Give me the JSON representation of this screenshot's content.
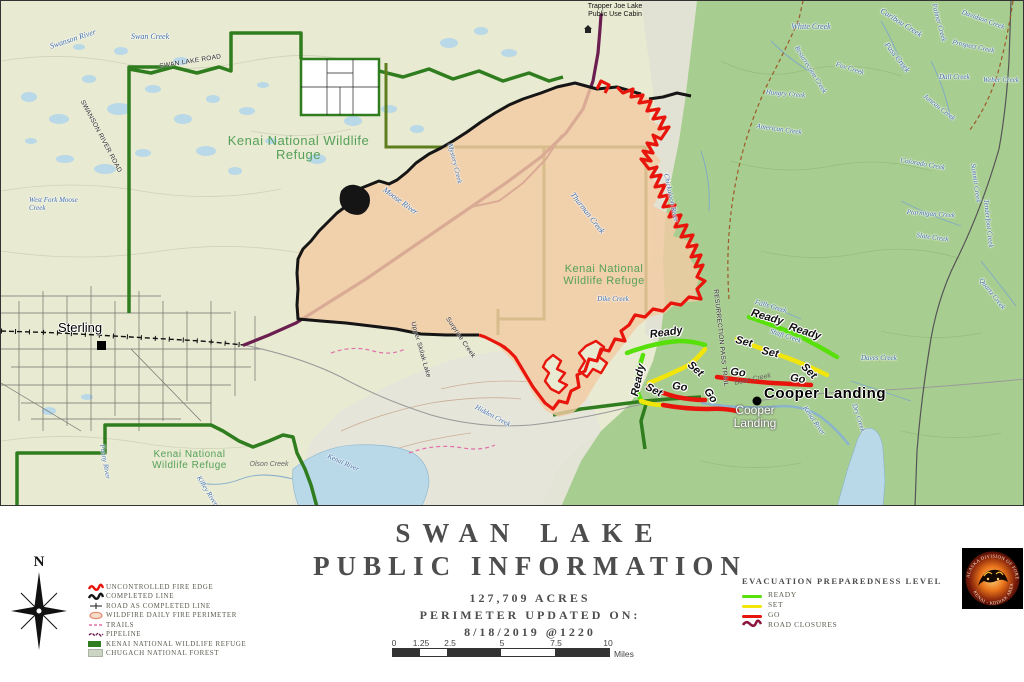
{
  "map": {
    "labels": {
      "swanson_river": "Swanson River",
      "swan_creek": "Swan Creek",
      "swan_lake_road": "SWAN LAKE ROAD",
      "swanson_river_road": "SWANSON RIVER ROAD",
      "refuge": "Kenai National Wildlife Refuge",
      "sterling": "Sterling",
      "trapper_joe": "Trapper Joe Lake Public Use Cabin",
      "moose_river": "Moose River",
      "mystery_creek": "Mystery Creek",
      "thurman_creek": "Thurman Creek",
      "dike_creek": "Dike Creek",
      "falls_creek": "Falls Creek",
      "shaft_creek": "Shaft Creek",
      "white_creek": "White Creek",
      "caribou_creek": "Caribou Creek",
      "pass_creek": "Pass Creek",
      "resurrection_creek": "Resurrection Creek",
      "fox_creek": "Fox Creek",
      "hungry_creek": "Hungry Creek",
      "dall_creek": "Dall Creek",
      "weber_creek": "Weber Creek",
      "american_creek": "American Creek",
      "colorado_creek": "Colorado Creek",
      "ptarmigan_creek": "Ptarmigan Creek",
      "slate_creek": "Slate Creek",
      "summit_creek": "Summit Creek",
      "tenderfoot_creek": "Tenderfoot Creek",
      "quartz_creek": "Quartz Creek",
      "juneau_creek": "Juneau Creek",
      "palmer_creek": "Palmer Creek",
      "prospect_creek": "Prospect Creek",
      "davidson_creek": "Davidson Creek",
      "olson_creek": "Olson Creek",
      "funny_river": "Funny River",
      "killey_river": "Killey River",
      "kenai_river": "Kenai River",
      "hidden_creek": "Hidden Creek",
      "upper_skilak": "Upper Skilak Lake",
      "surprise_creek": "Surprise Creek",
      "res_pass_trail": "RESURRECTION PASS TRAIL",
      "bean_creek": "Bean Creek",
      "daves_creek": "Daves Creek",
      "dry_creek": "Dry Creek",
      "chickaloon_river": "Chickaloon River",
      "west_fork": "West Fork Moose Creek",
      "cooper_landing": "Cooper Landing"
    },
    "evac": {
      "ready": "Ready",
      "set": "Set",
      "go": "Go"
    }
  },
  "footer": {
    "north": "N",
    "title_line1": "SWAN LAKE",
    "title_line2": "PUBLIC INFORMATION",
    "acres": "127,709 ACRES",
    "updated_label": "PERIMETER UPDATED ON:",
    "updated_value": "8/18/2019 @1220",
    "scale": {
      "ticks": [
        "0",
        "1.25",
        "2.5",
        "5",
        "7.5",
        "10"
      ],
      "unit": "Miles"
    },
    "legend": {
      "items": [
        "UNCONTROLLED FIRE EDGE",
        "COMPLETED LINE",
        "ROAD AS COMPLETED LINE",
        "WILDFIRE DAILY FIRE PERIMETER",
        "TRAILS",
        "PIPELINE",
        "KENAI NATIONAL WILDLIFE REFUGE",
        "CHUGACH NATIONAL FOREST"
      ]
    },
    "evac": {
      "title": "EVACUATION PREPAREDNESS LEVEL",
      "items": [
        "READY",
        "SET",
        "GO",
        "ROAD CLOSURES"
      ]
    },
    "logo": {
      "top": "ALASKA DIVISION OF FORESTRY",
      "bottom": "KENAI - KODIAK AREA"
    }
  },
  "colors": {
    "ready_green": "#57e00a",
    "set_yellow": "#f2e50a",
    "go_red": "#e8150c",
    "road_closure": "#8b1740",
    "fire_fill": "#f3cba4",
    "uncontrolled_edge": "#e8150c",
    "completed_line": "#151515",
    "pipeline_purple": "#6b1e50",
    "refuge_green": "#2f7d1f",
    "forest_green": "#a8cd90",
    "water_blue": "#b9d8e8"
  }
}
